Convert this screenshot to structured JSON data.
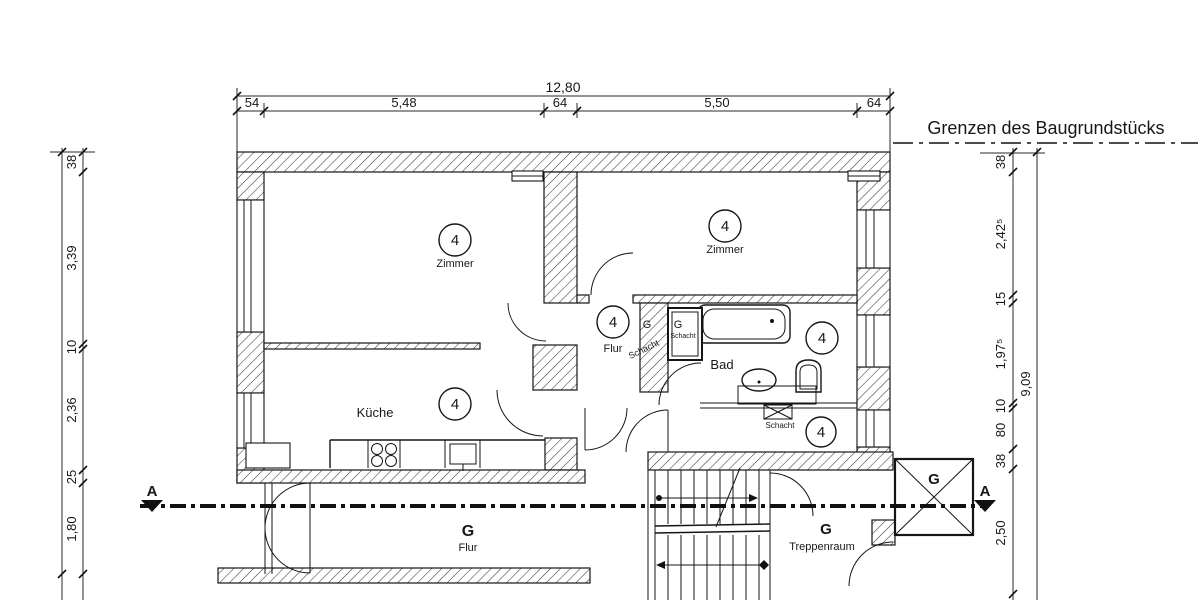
{
  "boundary": {
    "label": "Grenzen des Baugrundstücks"
  },
  "section": {
    "marker_left": "A",
    "marker_right": "A"
  },
  "dimensions": {
    "top": {
      "overall": "12,80",
      "seg": [
        "54",
        "5,48",
        "64",
        "5,50",
        "64"
      ]
    },
    "left": {
      "seg": [
        "38",
        "3,39",
        "10",
        "2,36",
        "25",
        "1,80"
      ]
    },
    "right": {
      "overall": "9,09",
      "seg": [
        "38",
        "2,42⁵",
        "15",
        "1,97⁵",
        "10",
        "80",
        "38"
      ],
      "lower": "2,50"
    }
  },
  "units": [
    {
      "number": "4",
      "room": "Zimmer"
    },
    {
      "number": "4",
      "room": "Zimmer"
    },
    {
      "number": "4",
      "room": "Küche"
    },
    {
      "number": "4",
      "room": "Flur"
    },
    {
      "number": "4",
      "room": "Bad"
    },
    {
      "number": "4",
      "room": ""
    }
  ],
  "shafts": {
    "g_left": "G",
    "g_right": "G",
    "label_diagonal": "Schacht",
    "label_inner": "Schacht",
    "label_strip": "Schacht"
  },
  "ground": {
    "flur_g": "G",
    "flur_label": "Flur",
    "trep_g": "G",
    "trep_label": "Treppenraum",
    "box_g": "G"
  }
}
